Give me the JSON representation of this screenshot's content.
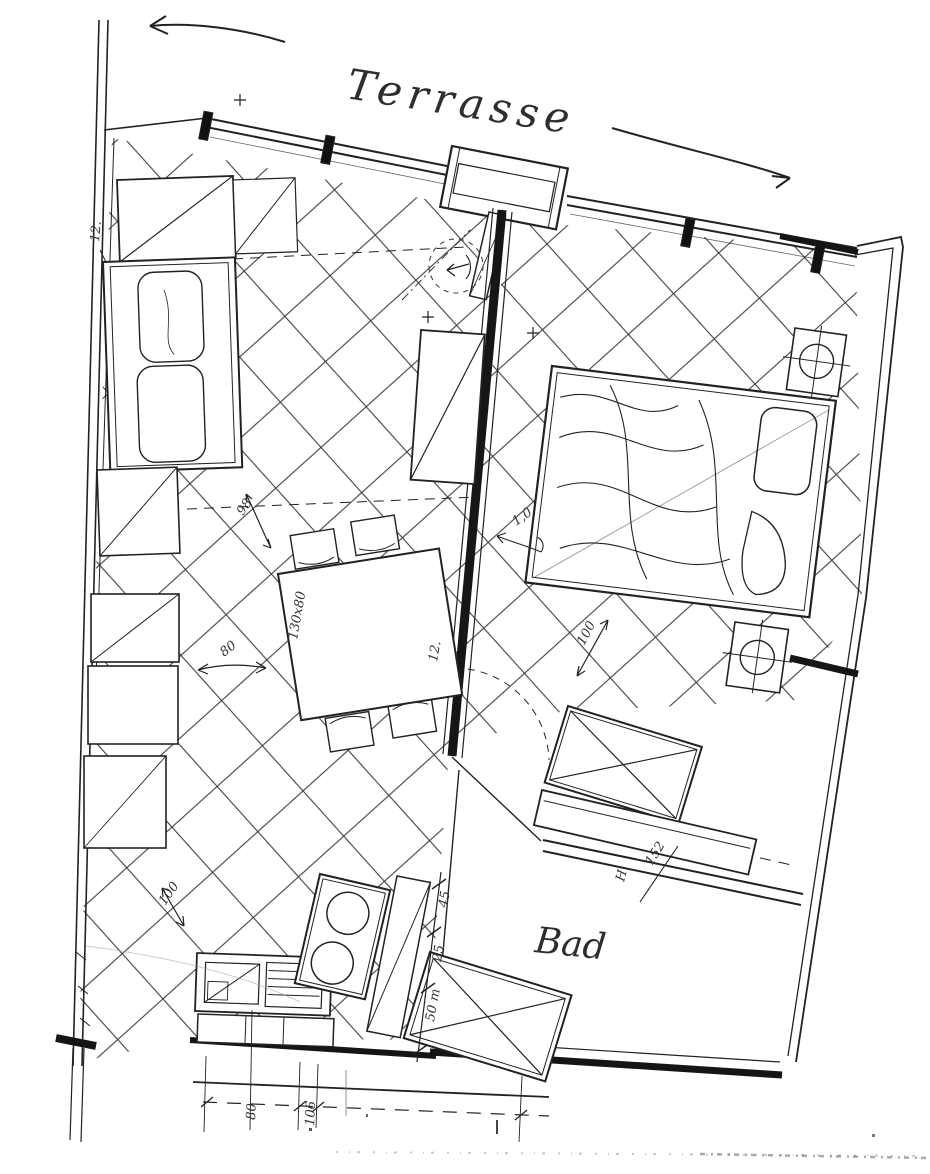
{
  "colors": {
    "paper": "#ffffff",
    "ink": "#1f1f1f",
    "pencil": "#3a3a3a",
    "hatch": "#3c3c3c"
  },
  "labels": {
    "terrace": "Terrasse",
    "bathroom": "Bad"
  },
  "annotations": {
    "left_wall_note": "12.",
    "center_wall_note": "12.",
    "living_width": "98",
    "table_size": "130x80",
    "walk_span": "80",
    "door_width": "1,0",
    "bedroom_gap": "100",
    "entry_gap": "100",
    "bath_length": "152",
    "bath_mark": "H",
    "kitchen_chain": [
      "45",
      "25",
      "50 m"
    ],
    "bottom_chain": [
      "80",
      "106"
    ]
  }
}
